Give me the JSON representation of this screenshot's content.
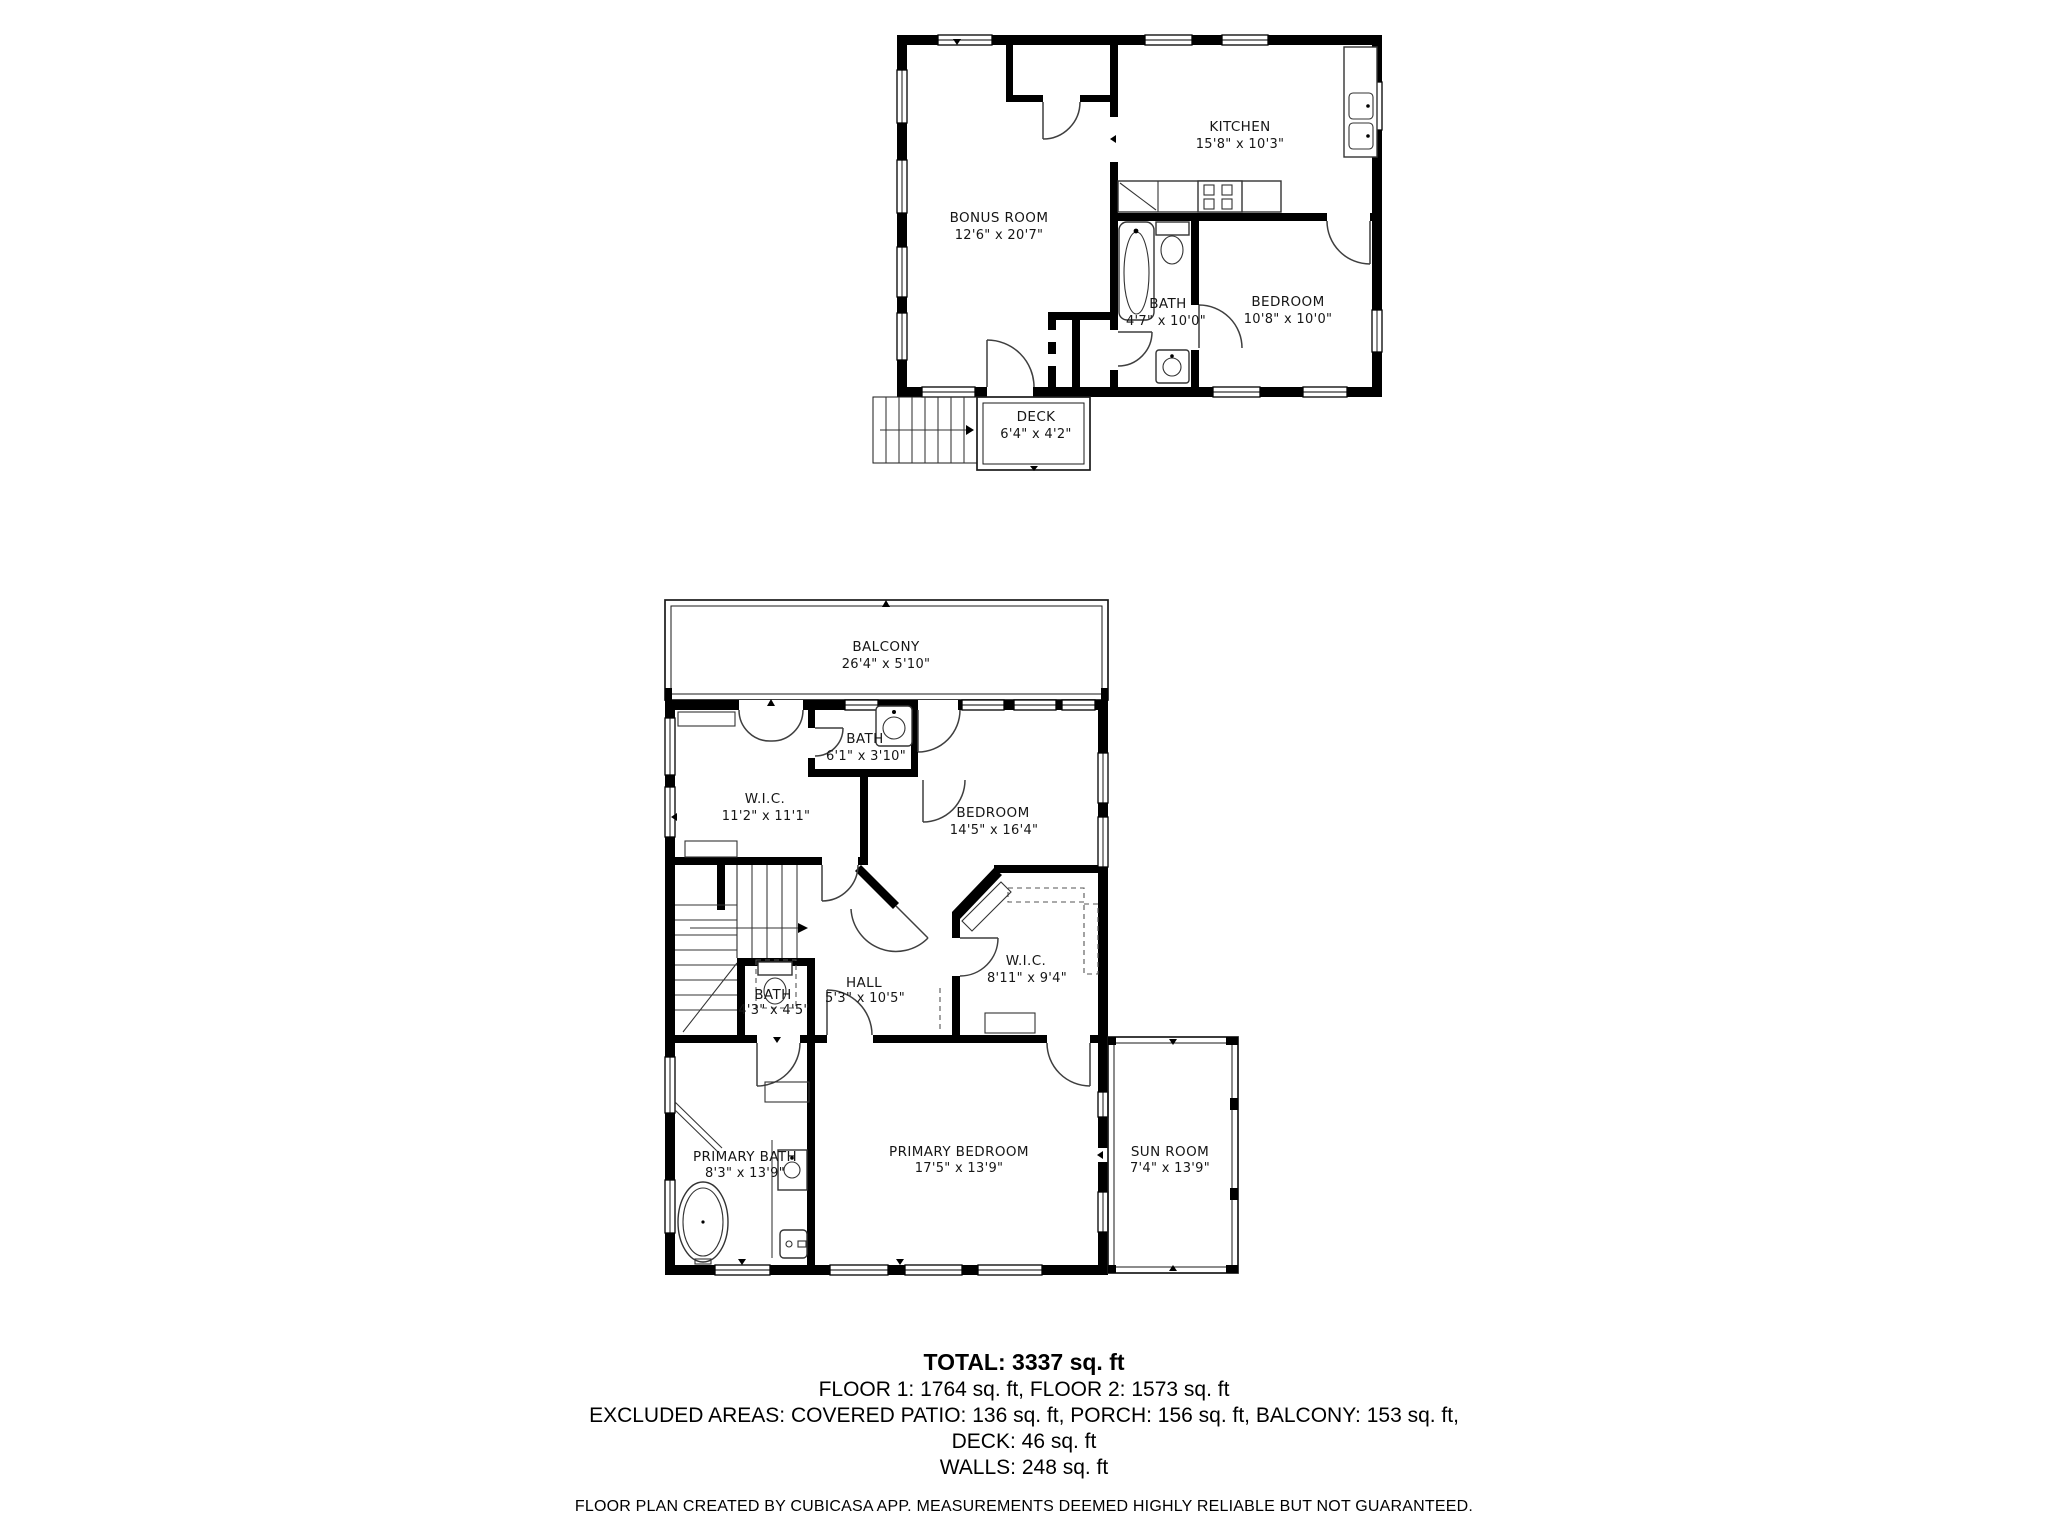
{
  "floor2": {
    "rooms": [
      {
        "name": "BONUS ROOM",
        "dims": "12'6\" x 20'7\""
      },
      {
        "name": "KITCHEN",
        "dims": "15'8\" x 10'3\""
      },
      {
        "name": "BATH",
        "dims": "4'7\" x 10'0\""
      },
      {
        "name": "BEDROOM",
        "dims": "10'8\" x 10'0\""
      },
      {
        "name": "DECK",
        "dims": "6'4\" x 4'2\""
      }
    ]
  },
  "floor1": {
    "rooms": [
      {
        "name": "BALCONY",
        "dims": "26'4\" x 5'10\""
      },
      {
        "name": "BATH",
        "dims": "6'1\" x 3'10\""
      },
      {
        "name": "W.I.C.",
        "dims": "11'2\" x 11'1\""
      },
      {
        "name": "BEDROOM",
        "dims": "14'5\" x 16'4\""
      },
      {
        "name": "W.I.C.",
        "dims": "8'11\" x 9'4\""
      },
      {
        "name": "BATH",
        "dims": "4'3\" x 4'5\""
      },
      {
        "name": "HALL",
        "dims": "5'3\" x 10'5\""
      },
      {
        "name": "PRIMARY BATH",
        "dims": "8'3\" x 13'9\""
      },
      {
        "name": "PRIMARY BEDROOM",
        "dims": "17'5\" x 13'9\""
      },
      {
        "name": "SUN ROOM",
        "dims": "7'4\" x 13'9\""
      }
    ]
  },
  "summary": {
    "total": "TOTAL: 3337 sq. ft",
    "floors": "FLOOR 1: 1764 sq. ft, FLOOR 2: 1573 sq. ft",
    "excluded": "EXCLUDED AREAS: COVERED PATIO: 136 sq. ft, PORCH: 156 sq. ft, BALCONY: 153 sq. ft,",
    "deck": "DECK: 46 sq. ft",
    "walls": "WALLS: 248 sq. ft"
  },
  "footer": "FLOOR PLAN CREATED BY CUBICASA APP. MEASUREMENTS DEEMED HIGHLY RELIABLE BUT NOT GUARANTEED.",
  "colors": {
    "wall": "#000000",
    "fixture": "#333333",
    "background": "#ffffff"
  }
}
